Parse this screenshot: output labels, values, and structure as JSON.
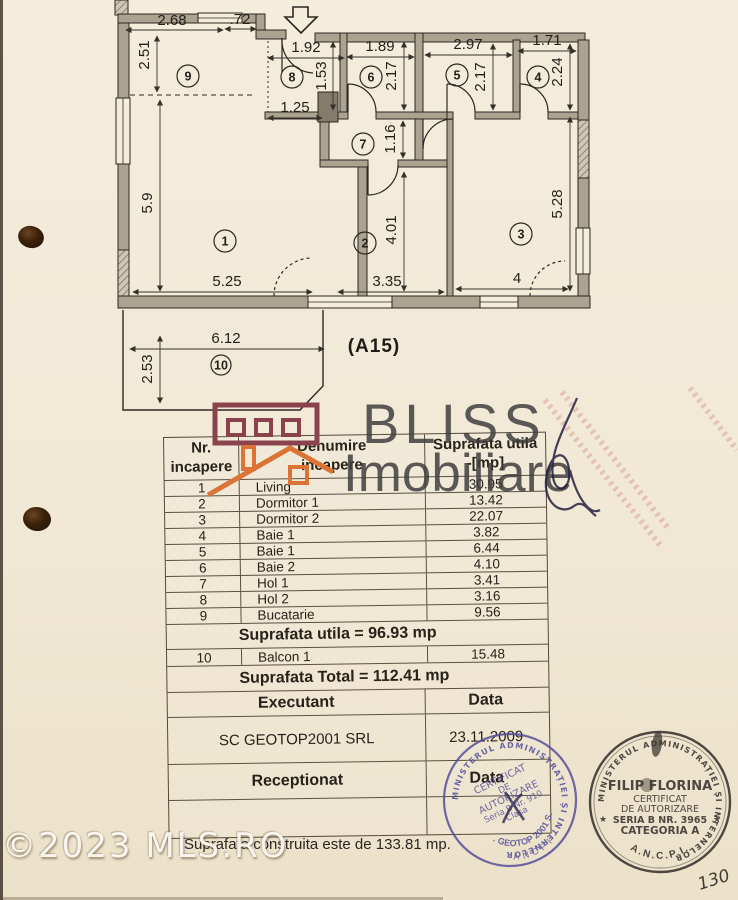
{
  "plan": {
    "unit_label": "(A15)",
    "rooms": {
      "r1": "1",
      "r2": "2",
      "r3": "3",
      "r4": "4",
      "r5": "5",
      "r6": "6",
      "r7": "7",
      "r8": "8",
      "r9": "9",
      "r10": "10"
    },
    "dims": {
      "w268": "2.68",
      "w72": ".72",
      "h251": "2.51",
      "w192": "1.92",
      "w189": "1.89",
      "w297": "2.97",
      "w171": "1.71",
      "h153": "1.53",
      "h217a": "2.17",
      "h217b": "2.17",
      "h224": "2.24",
      "w125": "1.25",
      "h116": "1.16",
      "h59": "5.9",
      "h401": "4.01",
      "h528": "5.28",
      "w525": "5.25",
      "w335": "3.35",
      "w4": "4",
      "w612": "6.12",
      "h253": "2.53"
    }
  },
  "logo": {
    "brand_line1": "BLISS",
    "brand_line2": "Imobiliare"
  },
  "table": {
    "headers": {
      "col1_line1": "Nr.",
      "col1_line2": "incapere",
      "col2_line1": "Denumire",
      "col2_line2": "incapere",
      "col3_line1": "Suprafata utila",
      "col3_line2": "-[mp]"
    },
    "rows": [
      {
        "nr": "1",
        "name": "Living",
        "area": "30.95"
      },
      {
        "nr": "2",
        "name": "Dormitor 1",
        "area": "13.42"
      },
      {
        "nr": "3",
        "name": "Dormitor 2",
        "area": "22.07"
      },
      {
        "nr": "4",
        "name": "Baie 1",
        "area": "3.82"
      },
      {
        "nr": "5",
        "name": "Baie 1",
        "area": "6.44"
      },
      {
        "nr": "6",
        "name": "Baie 2",
        "area": "4.10"
      },
      {
        "nr": "7",
        "name": "Hol 1",
        "area": "3.41"
      },
      {
        "nr": "8",
        "name": "Hol 2",
        "area": "3.16"
      },
      {
        "nr": "9",
        "name": "Bucatarie",
        "area": "9.56"
      }
    ],
    "subtotal_label": "Suprafata utila = 96.93 mp",
    "balcony_row": {
      "nr": "10",
      "name": "Balcon 1",
      "area": "15.48"
    },
    "total_label": "Suprafata Total = 112.41 mp",
    "executant_label": "Executant",
    "data_label": "Data",
    "executant_value": "SC GEOTOP2001 SRL",
    "executant_date": "23.11.2009",
    "receptionat_label": "Receptionat",
    "receptionat_data_label": "Data"
  },
  "stamps": {
    "left": {
      "ring_text": "MINISTERUL ADMINISTRAȚIEI ȘI INTERNELOR",
      "line1": "CERTIFICAT",
      "line2": "DE",
      "line3": "AUTORIZARE",
      "line4": "Seria B Nr. 910",
      "line5": "Clasa",
      "company": "S.C. GEOTOP 2001 S.R.L.",
      "bottom": "ANCPI"
    },
    "right": {
      "ring_text": "MINISTERUL ADMINISTRAȚIEI ȘI INTERNELOR",
      "name": "FILIP FLORINA",
      "line1": "CERTIFICAT",
      "line2": "DE AUTORIZARE",
      "line3": "SERIA B NR. 3965",
      "line4": "CATEGORIA A",
      "bottom": "A.N.C.P.I.",
      "star": "★"
    }
  },
  "footer": {
    "construita_text": "Suprafata construita este de 133.81 mp.",
    "mls_watermark": "©2023 MLS.RO",
    "page_number": "130"
  }
}
